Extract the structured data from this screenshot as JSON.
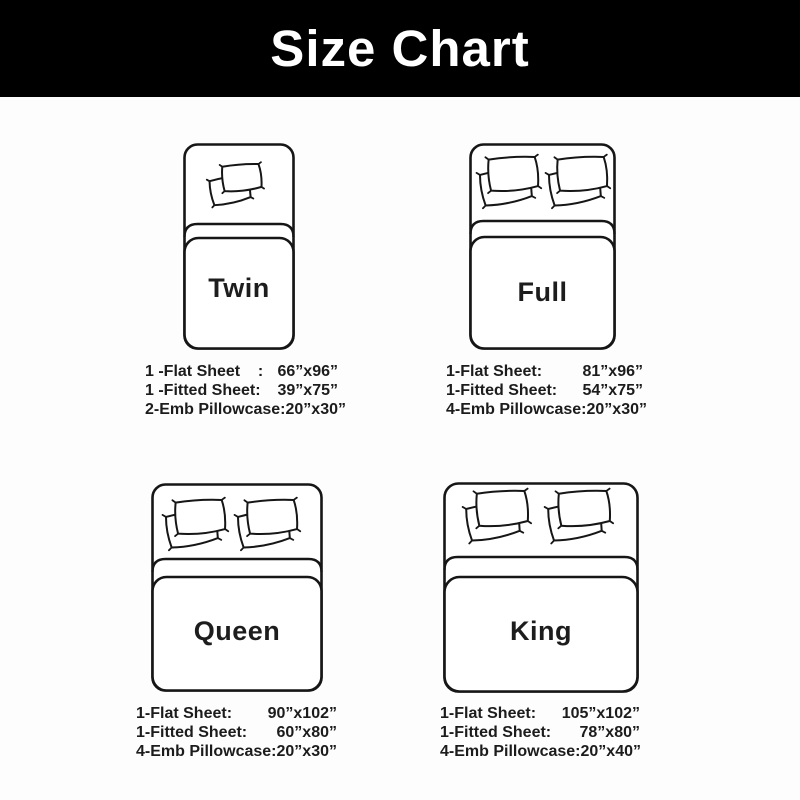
{
  "header": {
    "title": "Size Chart"
  },
  "colors": {
    "header_bg": "#000000",
    "header_text": "#ffffff",
    "line": "#161616",
    "text": "#1c1c1c",
    "background": "#fdfdfd"
  },
  "sizes": [
    {
      "id": "twin",
      "label": "Twin",
      "pillow_count": 2,
      "specs": [
        {
          "label": "1 -Flat Sheet    :",
          "value": "66”x96”"
        },
        {
          "label": "1 -Fitted Sheet:",
          "value": "39”x75”"
        },
        {
          "label": "2-Emb Pillowcase:",
          "value": "20”x30”"
        }
      ]
    },
    {
      "id": "full",
      "label": "Full",
      "pillow_count": 4,
      "specs": [
        {
          "label": "1-Flat Sheet:",
          "value": "81”x96”"
        },
        {
          "label": "1-Fitted Sheet:",
          "value": "54”x75”"
        },
        {
          "label": "4-Emb Pillowcase:",
          "value": "20”x30”"
        }
      ]
    },
    {
      "id": "queen",
      "label": "Queen",
      "pillow_count": 4,
      "specs": [
        {
          "label": "1-Flat Sheet:",
          "value": "90”x102”"
        },
        {
          "label": "1-Fitted Sheet:",
          "value": "60”x80”"
        },
        {
          "label": "4-Emb Pillowcase:",
          "value": "20”x30”"
        }
      ]
    },
    {
      "id": "king",
      "label": "King",
      "pillow_count": 4,
      "specs": [
        {
          "label": "1-Flat Sheet:",
          "value": "105”x102”"
        },
        {
          "label": "1-Fitted Sheet:",
          "value": "78”x80”"
        },
        {
          "label": "4-Emb Pillowcase:",
          "value": "20”x40”"
        }
      ]
    }
  ]
}
